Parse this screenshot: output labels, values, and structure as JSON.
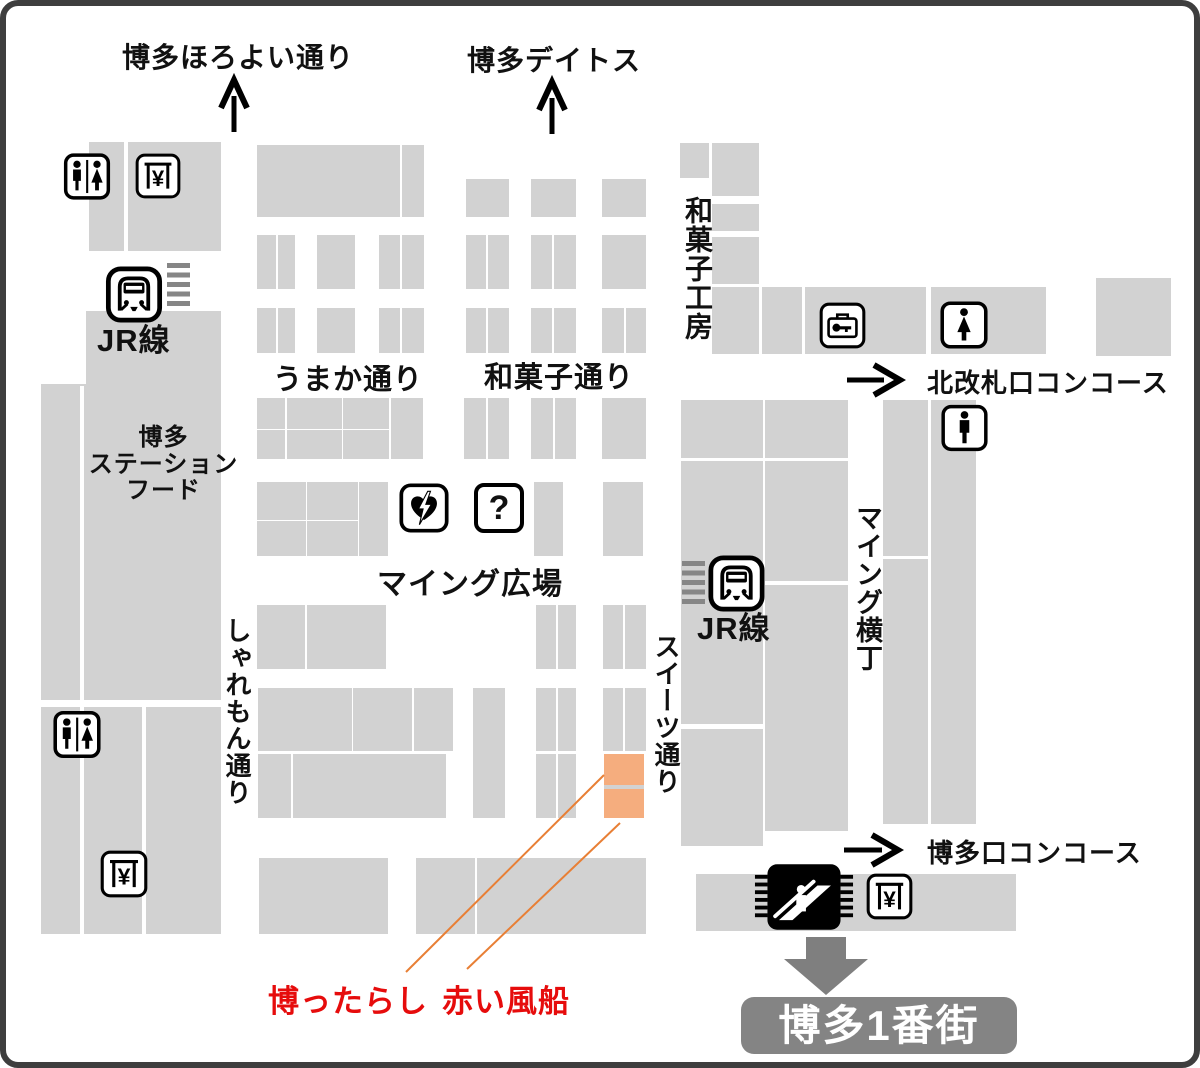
{
  "colors": {
    "block": "#d2d2d2",
    "orange": "#f5ad7e",
    "orange-line": "#e87f35",
    "red": "#e60c0c",
    "badge-bg": "#848484",
    "arrow-gray": "#7f7f7f",
    "frame": "#3e3e3e",
    "stairs": "#868686",
    "text": "#111111"
  },
  "labels": {
    "street_horoyoi": "博多ほろよい通り",
    "dest_deitos": "博多デイトス",
    "shop_wagashi_kobo": "和菓子工房",
    "jr_line_left": "JR線",
    "street_umaka": "うまか通り",
    "street_wagashi": "和菓子通り",
    "dest_north_concourse": "北改札口コンコース",
    "station_food_line1": "博多",
    "station_food_line2": "ステーション",
    "station_food_line3": "フード",
    "plaza_ming": "マイング広場",
    "jr_line_mid": "JR線",
    "street_ming_yokocho": "マイング横丁",
    "street_sharemon": "しゃれもん通り",
    "street_sweets": "スイーツ通り",
    "dest_hakataguchi_concourse": "博多口コンコース",
    "shop_hakattarashi": "博ったらし",
    "shop_akai_fusen": "赤い風船",
    "dest_ichibangai": "博多1番街",
    "yen_symbol": "¥",
    "question_mark": "?"
  },
  "highlighted_shops": [
    "博ったらし",
    "赤い風船"
  ],
  "icons": [
    "restroom-male-female",
    "yen-service",
    "train",
    "stairs",
    "coin-locker",
    "restroom-female",
    "restroom-male",
    "aed",
    "information",
    "escalator",
    "up-arrow",
    "right-arrow",
    "down-arrow"
  ],
  "map_geometry": {
    "blocks": [
      [
        83,
        136,
        35,
        109
      ],
      [
        122,
        136,
        93,
        109
      ],
      [
        80,
        305,
        135,
        75
      ],
      [
        35,
        378,
        180,
        550
      ],
      [
        74,
        380,
        4,
        548,
        "g"
      ],
      [
        136,
        700,
        4,
        228,
        "g"
      ],
      [
        35,
        694,
        180,
        7,
        "g"
      ],
      [
        251,
        139,
        143,
        72
      ],
      [
        396,
        139,
        22,
        72
      ],
      [
        460,
        173,
        43,
        38
      ],
      [
        525,
        173,
        45,
        38
      ],
      [
        596,
        173,
        44,
        38
      ],
      [
        251,
        229,
        19,
        54
      ],
      [
        272,
        229,
        17,
        54
      ],
      [
        311,
        229,
        38,
        54
      ],
      [
        373,
        229,
        21,
        54
      ],
      [
        396,
        229,
        22,
        54
      ],
      [
        460,
        229,
        20,
        54
      ],
      [
        482,
        229,
        21,
        54
      ],
      [
        525,
        229,
        21,
        54
      ],
      [
        548,
        229,
        22,
        54
      ],
      [
        596,
        229,
        44,
        54
      ],
      [
        251,
        302,
        19,
        45
      ],
      [
        272,
        302,
        17,
        45
      ],
      [
        311,
        302,
        38,
        45
      ],
      [
        373,
        302,
        21,
        45
      ],
      [
        396,
        302,
        22,
        45
      ],
      [
        460,
        302,
        20,
        45
      ],
      [
        482,
        302,
        21,
        45
      ],
      [
        525,
        302,
        21,
        45
      ],
      [
        548,
        302,
        22,
        45
      ],
      [
        596,
        302,
        22,
        45
      ],
      [
        620,
        302,
        20,
        45
      ],
      [
        674,
        137,
        29,
        35
      ],
      [
        706,
        137,
        47,
        53
      ],
      [
        706,
        198,
        47,
        27
      ],
      [
        706,
        231,
        47,
        47
      ],
      [
        706,
        281,
        47,
        67
      ],
      [
        756,
        281,
        40,
        67
      ],
      [
        799,
        281,
        121,
        67
      ],
      [
        925,
        281,
        115,
        67
      ],
      [
        1090,
        272,
        75,
        78
      ],
      [
        251,
        392,
        28,
        31
      ],
      [
        281,
        392,
        55,
        31
      ],
      [
        337,
        392,
        46,
        31
      ],
      [
        251,
        424,
        28,
        29
      ],
      [
        281,
        424,
        55,
        29
      ],
      [
        337,
        424,
        46,
        29
      ],
      [
        385,
        392,
        32,
        61
      ],
      [
        458,
        392,
        22,
        61
      ],
      [
        482,
        392,
        21,
        61
      ],
      [
        525,
        392,
        22,
        61
      ],
      [
        549,
        392,
        21,
        61
      ],
      [
        596,
        392,
        44,
        61
      ],
      [
        251,
        476,
        49,
        38
      ],
      [
        301,
        476,
        51,
        38
      ],
      [
        251,
        515,
        49,
        35
      ],
      [
        301,
        515,
        51,
        35
      ],
      [
        353,
        476,
        29,
        74
      ],
      [
        528,
        476,
        29,
        74
      ],
      [
        597,
        476,
        40,
        74
      ],
      [
        251,
        599,
        48,
        64
      ],
      [
        301,
        599,
        79,
        64
      ],
      [
        530,
        599,
        20,
        64
      ],
      [
        552,
        599,
        18,
        64
      ],
      [
        597,
        599,
        20,
        64
      ],
      [
        619,
        599,
        21,
        64
      ],
      [
        252,
        682,
        94,
        63
      ],
      [
        347,
        682,
        59,
        63
      ],
      [
        408,
        682,
        39,
        63
      ],
      [
        467,
        682,
        32,
        130
      ],
      [
        530,
        682,
        20,
        63
      ],
      [
        552,
        682,
        18,
        63
      ],
      [
        597,
        682,
        20,
        63
      ],
      [
        619,
        682,
        21,
        63
      ],
      [
        252,
        748,
        33,
        64
      ],
      [
        287,
        748,
        153,
        64
      ],
      [
        530,
        748,
        20,
        64
      ],
      [
        552,
        748,
        18,
        64
      ],
      [
        598,
        748,
        40,
        31,
        "o"
      ],
      [
        598,
        779,
        40,
        4
      ],
      [
        598,
        783,
        40,
        29,
        "o"
      ],
      [
        253,
        852,
        129,
        76
      ],
      [
        410,
        852,
        59,
        76
      ],
      [
        471,
        852,
        169,
        76
      ],
      [
        675,
        394,
        82,
        58
      ],
      [
        675,
        455,
        82,
        385
      ],
      [
        675,
        718,
        82,
        5,
        "g"
      ],
      [
        759,
        394,
        83,
        58
      ],
      [
        759,
        455,
        83,
        370
      ],
      [
        759,
        575,
        83,
        4,
        "g"
      ],
      [
        877,
        394,
        45,
        156
      ],
      [
        877,
        553,
        45,
        265
      ],
      [
        925,
        394,
        45,
        424
      ],
      [
        690,
        868,
        320,
        57
      ]
    ]
  }
}
